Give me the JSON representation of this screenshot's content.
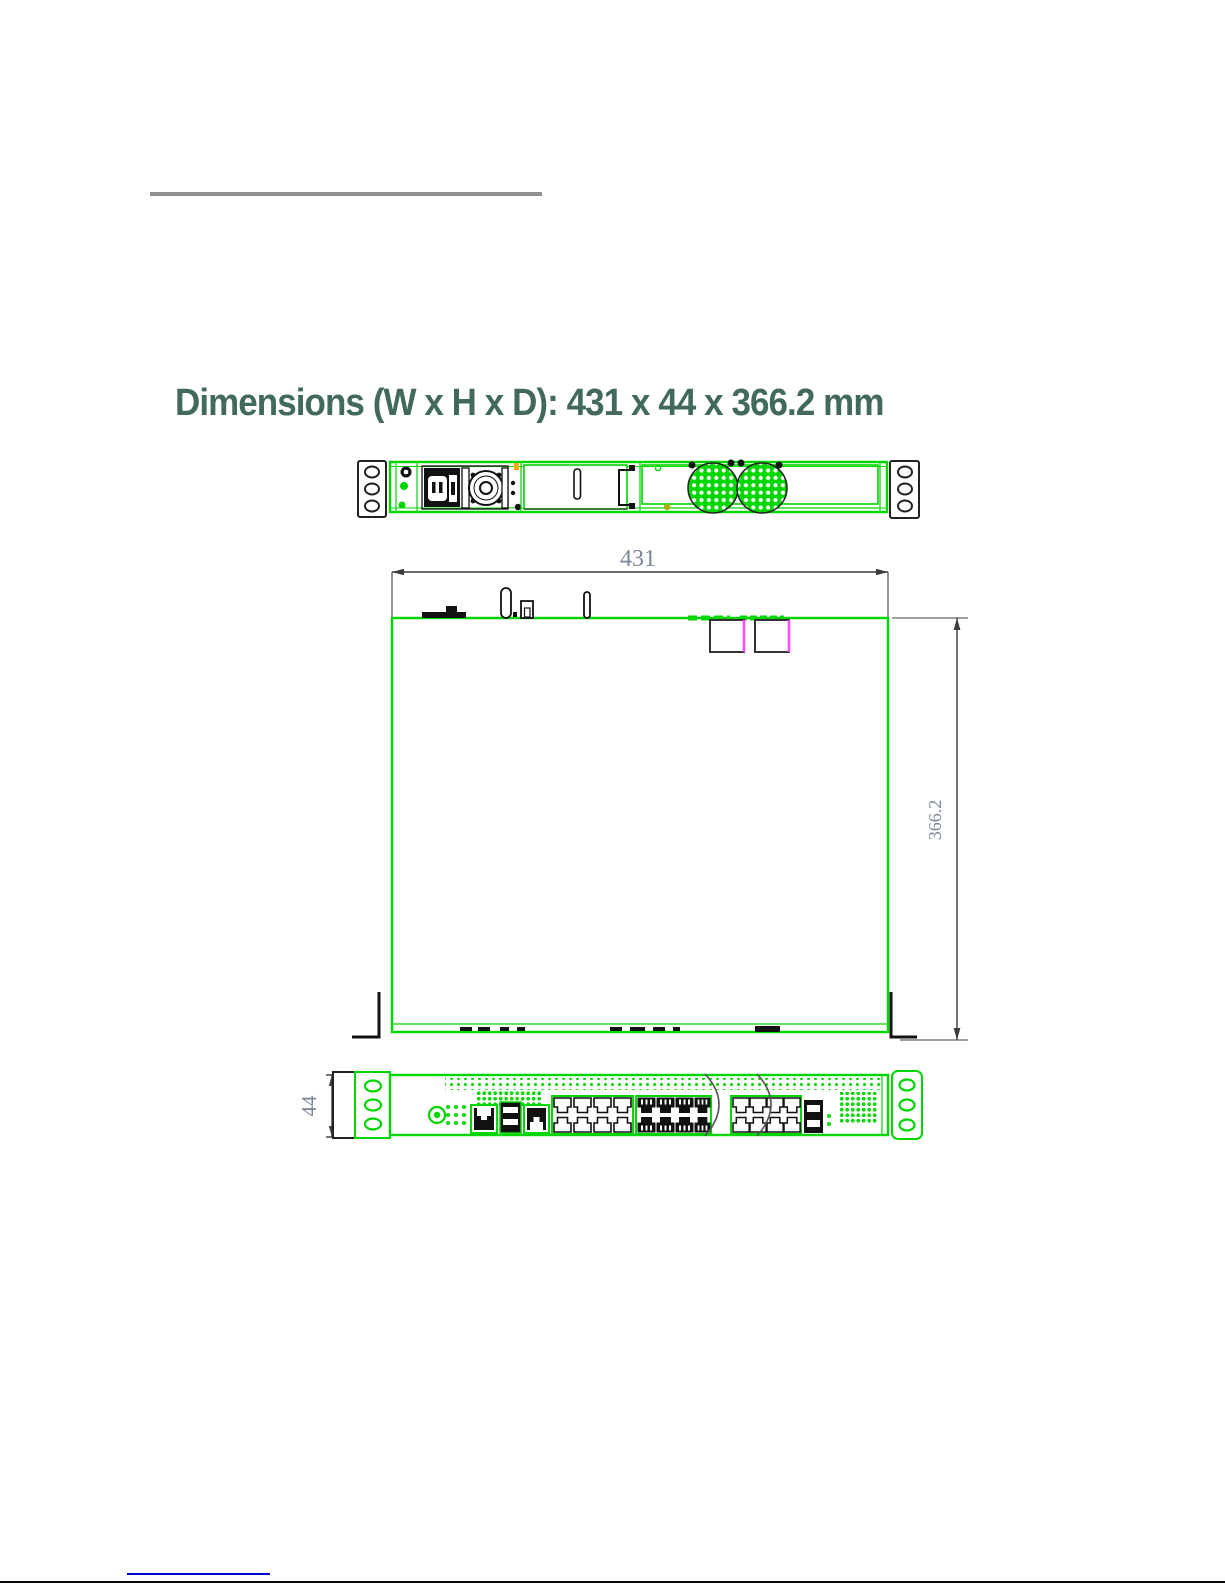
{
  "title": {
    "text": "Dimensions (W x H x D): 431 x 44 x 366.2 mm",
    "color": "#426a5b"
  },
  "drawing": {
    "labels": {
      "width": "431",
      "depth": "366.2",
      "height": "44"
    },
    "colors": {
      "line_green": "#00d600",
      "detail_black": "#1a1a1a",
      "dimension_gray": "#3c3c3c",
      "dimension_text": "#7b8698",
      "magenta_accent": "#ff4dff",
      "orange_accent": "#ffaa00"
    }
  },
  "footer": {
    "link_line_color": "#0000cc"
  }
}
